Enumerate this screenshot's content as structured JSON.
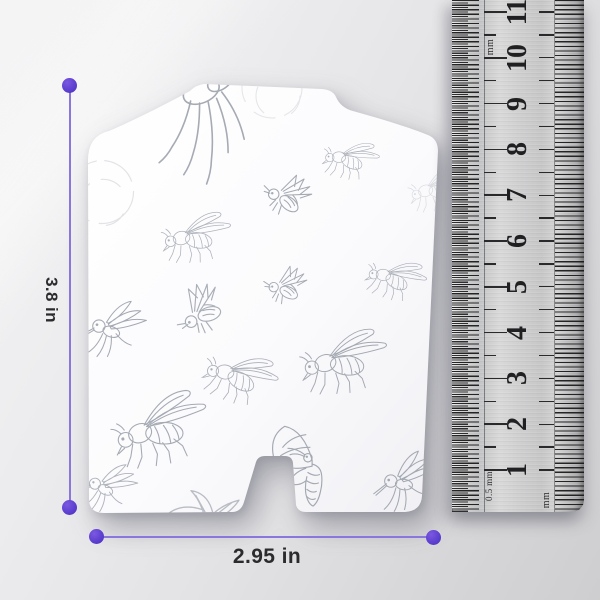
{
  "annotations": {
    "height_label": "3.8 in",
    "width_label": "2.95 in",
    "accent_color": "#5b3ecf",
    "line_color": "#8a76dd"
  },
  "ruler": {
    "unit_label_top": "mm",
    "unit_label_bottom_left": "0.5 mm",
    "unit_label_bottom_right": "mm",
    "cm_numbers": [
      1,
      2,
      3,
      4,
      5,
      6,
      7,
      8,
      9,
      10,
      11
    ],
    "cm_start_y": 470,
    "cm_spacing": 45.8
  },
  "card": {
    "sketch_color": "#8f95a0",
    "sketches": [
      {
        "type": "hangfly",
        "x": 207,
        "y": 146,
        "s": 1.45,
        "r": -6,
        "o": 0.8
      },
      {
        "type": "arcs",
        "x": 272,
        "y": 88,
        "s": 1.0,
        "r": 0,
        "o": 0.22
      },
      {
        "type": "arcs",
        "x": 102,
        "y": 192,
        "s": 1.05,
        "r": 30,
        "o": 0.25
      },
      {
        "type": "fly",
        "x": 194,
        "y": 236,
        "s": 0.7,
        "r": -6,
        "o": 0.7
      },
      {
        "type": "fly",
        "x": 349,
        "y": 158,
        "s": 0.56,
        "r": 8,
        "o": 0.75
      },
      {
        "type": "bee",
        "x": 287,
        "y": 198,
        "s": 0.95,
        "r": 0,
        "o": 0.8
      },
      {
        "type": "fly",
        "x": 436,
        "y": 188,
        "s": 0.6,
        "r": -12,
        "o": 0.3
      },
      {
        "type": "bee",
        "x": 286,
        "y": 288,
        "s": 0.85,
        "r": -12,
        "o": 0.8
      },
      {
        "type": "bee",
        "x": 203,
        "y": 312,
        "s": 1.05,
        "r": -55,
        "o": 0.75
      },
      {
        "type": "mosq",
        "x": 116,
        "y": 328,
        "s": 0.95,
        "r": 0,
        "o": 0.8
      },
      {
        "type": "fly",
        "x": 394,
        "y": 277,
        "s": 0.6,
        "r": 14,
        "o": 0.75
      },
      {
        "type": "fly",
        "x": 341,
        "y": 360,
        "s": 0.88,
        "r": -8,
        "o": 0.8
      },
      {
        "type": "fly",
        "x": 238,
        "y": 375,
        "s": 0.74,
        "r": 16,
        "o": 0.75
      },
      {
        "type": "fly",
        "x": 157,
        "y": 428,
        "s": 0.98,
        "r": -14,
        "o": 0.8
      },
      {
        "type": "moth",
        "x": 310,
        "y": 462,
        "s": 1.05,
        "r": 0,
        "o": 0.8
      },
      {
        "type": "mosq",
        "x": 408,
        "y": 480,
        "s": 0.95,
        "r": -10,
        "o": 0.8
      },
      {
        "type": "leaf",
        "x": 203,
        "y": 505,
        "s": 1.2,
        "r": 0,
        "o": 0.6
      },
      {
        "type": "mosq",
        "x": 110,
        "y": 487,
        "s": 0.85,
        "r": 6,
        "o": 0.7
      }
    ]
  }
}
